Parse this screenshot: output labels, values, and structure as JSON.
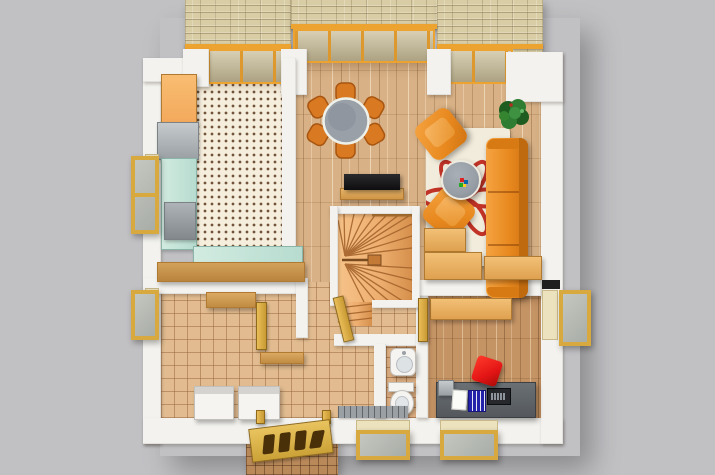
{
  "meta": {
    "type": "3d-floor-plan-render",
    "view": "top-down ground floor, photoreal render on gray backdrop",
    "canvas": {
      "width": 715,
      "height": 475
    }
  },
  "palette": {
    "background": "#c1c1c4",
    "wall_white": "#f3f2ee",
    "stone_base": "#d9cda5",
    "glass_gold": "#eda32f",
    "glass_pane": "#c9bd98",
    "wood_light": "#d8b186",
    "wood_office": "#c59465",
    "tile_hall": "#e2bc90",
    "tile_wc": "#dfb083",
    "kitchen_floor": "#f6eedd",
    "counter_teal": "#b7dccf",
    "cabinet_orange": "#f3a95c",
    "furniture_orange": "#e8891f",
    "rug_cream": "#f2ecdc",
    "rug_red": "#c23327",
    "table_gray": "#989ea6",
    "plant_green": "#2e7d32",
    "stair_wood": "#eeaf70",
    "door_gold": "#d8a93f",
    "desk_gray": "#54585c",
    "chair_red": "#e31515",
    "appliance_white": "#f6f4f1",
    "stoop_tile": "#b9895a",
    "mat_gray": "#9aa0a4"
  },
  "scene": {
    "rooms": [
      {
        "id": "kitchen",
        "label": "Kitchen (dotted tile floor)"
      },
      {
        "id": "dining-area",
        "label": "Dining area (wood floor)"
      },
      {
        "id": "living-room",
        "label": "Living room (wood floor)"
      },
      {
        "id": "hallway",
        "label": "Hallway (tiled floor)"
      },
      {
        "id": "utility-room",
        "label": "Utility room (tiled floor)"
      },
      {
        "id": "wc",
        "label": "WC (tiled floor)"
      },
      {
        "id": "study",
        "label": "Study (wood floor)"
      },
      {
        "id": "staircase",
        "label": "Winder staircase"
      },
      {
        "id": "entrance",
        "label": "Entrance porch with open front door"
      }
    ],
    "furniture": {
      "dining_set": "Round glass dining table with 6 orange chairs",
      "sofa": "Orange three-seat sofa",
      "armchair_top": "Orange armchair (angled)",
      "armchair_bottom": "Orange armchair (angled)",
      "rug": "Cream rug with red petal pattern",
      "coffee_table": "Round gray coffee table",
      "plant": "Green potted plant",
      "sideboard": "Black-top sideboard / TV board",
      "cabinets": "Tan storage cabinets",
      "desk": "Study desk with paper, binders and laptop",
      "office_chair": "Red desk chair",
      "sink": "Wash basin",
      "toilet": "Toilet",
      "washer": "Washing machine",
      "dryer": "Dryer",
      "kitchen_counter": "Teal kitchen counters with stove, hood and sink",
      "kitchen_cabinet": "Orange tall cabinet",
      "bar_counter": "Wooden counter bar",
      "front_door": "Open paneled front door",
      "window": "Gold-framed open window",
      "glazing": "Orange-framed glass wall in stone facade",
      "mat": "Gray doormat",
      "stairs": "Wooden winder stairs"
    }
  }
}
